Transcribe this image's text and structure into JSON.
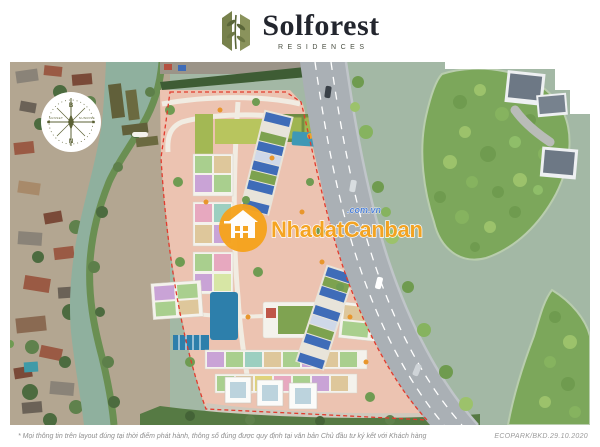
{
  "header": {
    "brand": "Solforest",
    "brand_sub": "RESIDENCES"
  },
  "compass": {
    "north_label": "B",
    "south_label": "N",
    "west_label": "SUNSET",
    "east_label": "SUNRISE"
  },
  "watermark": {
    "name": "NhadatCanban",
    "domain": ".com.vn"
  },
  "footer": {
    "disclaimer": "* Mọi thông tin trên layout đúng tại thời điểm phát hành, thông số đúng được quy định tại văn bản Chủ đầu tư ký kết với Khách hàng",
    "code": "ECOPARK/BKD.29.10.2020"
  },
  "colors": {
    "boundary_red": "#e23b2e",
    "watermark_orange": "#f6a31d",
    "watermark_blue": "#4a7fd8",
    "logo_olive": "#77814c",
    "site_ground_pink": "#ecc3b1",
    "river_water": "#a3b8a5",
    "canal_water": "#8fb09e",
    "road_gray": "#aab0b5",
    "solar_roof_blue": "#3f6cb8",
    "pool_blue": "#2d7fab"
  }
}
